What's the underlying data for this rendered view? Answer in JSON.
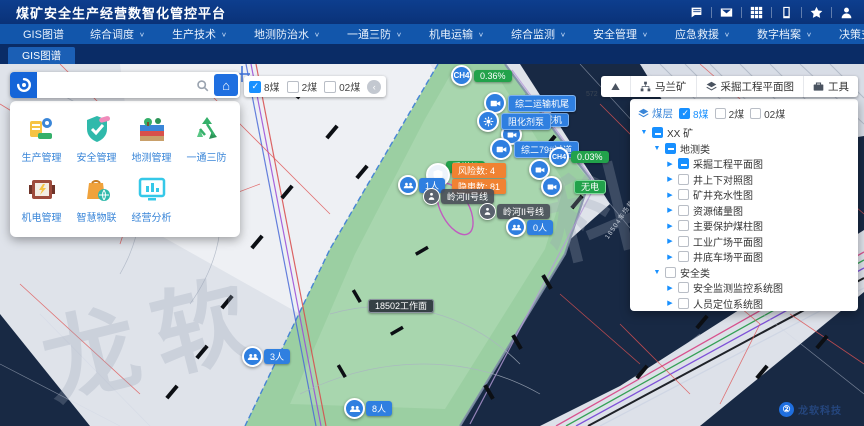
{
  "header": {
    "title": "煤矿安全生产经营数智化管控平台",
    "icons": [
      "chat-icon",
      "mail-icon",
      "apps-grid-icon",
      "mobile-icon",
      "star-icon",
      "user-icon"
    ]
  },
  "nav": {
    "items": [
      {
        "label": "GIS图谱",
        "dropdown": false
      },
      {
        "label": "综合调度",
        "dropdown": true
      },
      {
        "label": "生产技术",
        "dropdown": true
      },
      {
        "label": "地测防治水",
        "dropdown": true
      },
      {
        "label": "一通三防",
        "dropdown": true
      },
      {
        "label": "机电运输",
        "dropdown": true
      },
      {
        "label": "综合监测",
        "dropdown": true
      },
      {
        "label": "安全管理",
        "dropdown": true
      },
      {
        "label": "应急救援",
        "dropdown": true
      },
      {
        "label": "数字档案",
        "dropdown": true
      },
      {
        "label": "决策支持",
        "dropdown": true
      },
      {
        "label": "系统管理",
        "dropdown": true
      }
    ]
  },
  "tabs": {
    "active": "GIS图谱"
  },
  "apps": {
    "items": [
      {
        "label": "生产管理"
      },
      {
        "label": "安全管理"
      },
      {
        "label": "地测管理"
      },
      {
        "label": "一通三防"
      },
      {
        "label": "机电管理"
      },
      {
        "label": "智慧物联"
      },
      {
        "label": "经营分析"
      }
    ]
  },
  "coal_toolbar": {
    "options": [
      {
        "label": "8煤",
        "checked": true
      },
      {
        "label": "2煤",
        "checked": false
      },
      {
        "label": "02煤",
        "checked": false
      }
    ]
  },
  "right_toolbar": {
    "buttons": [
      {
        "label": "",
        "icon": "mine-icon"
      },
      {
        "label": "马兰矿",
        "icon": "org-tree-icon"
      },
      {
        "label": "采掘工程平面图",
        "icon": "layers-icon"
      },
      {
        "label": "工具",
        "icon": "toolbox-icon"
      }
    ]
  },
  "layer_panel": {
    "seam_label": "煤层",
    "seams": [
      {
        "label": "8煤",
        "checked": true
      },
      {
        "label": "2煤",
        "checked": false
      },
      {
        "label": "02煤",
        "checked": false
      }
    ],
    "tree": [
      {
        "label": "XX 矿"
      },
      {
        "label": "地测类"
      },
      {
        "label": "采掘工程平面图"
      },
      {
        "label": "井上下对照图"
      },
      {
        "label": "矿井充水性图"
      },
      {
        "label": "资源储量图"
      },
      {
        "label": "主要保护煤柱图"
      },
      {
        "label": "工业广场平面图"
      },
      {
        "label": "井底车场平面图"
      },
      {
        "label": "安全类"
      },
      {
        "label": "安全监测监控系统图"
      },
      {
        "label": "人员定位系统图"
      }
    ]
  },
  "map": {
    "markers": {
      "ch4_1": {
        "gas": "CH4",
        "value": "0.36%"
      },
      "ch4_2": {
        "gas": "CH4",
        "value": "0.03%"
      },
      "cam_transporter": {
        "label": "综二运输机尾"
      },
      "loader": {
        "label": "转载机"
      },
      "pump": {
        "label": "阻化剂泵"
      },
      "crossing": {
        "label": "综二79#过道"
      },
      "shearer": {
        "label": "采煤机"
      },
      "no_power": {
        "label": "无电"
      },
      "risk": {
        "label": "风险数: 4"
      },
      "hazard": {
        "label": "隐患数: 81"
      },
      "line1": {
        "label": "岭河II号线"
      },
      "line2": {
        "label": "岭河II号线"
      },
      "people_1": {
        "label": "1人"
      },
      "people_0": {
        "label": "0人"
      },
      "people_3": {
        "label": "3人"
      },
      "people_8": {
        "label": "8人"
      },
      "workface": {
        "label": "18502工作面"
      }
    },
    "texts": {
      "elevation": "572",
      "corridor": "18504车场巷"
    },
    "logo": {
      "label": "龙软科技"
    },
    "colors": {
      "background": "#182944",
      "paper": "#dfe3ea",
      "workface_green": "#9bcfa2",
      "marker_blue": "#2f7fe0",
      "ok_green": "#22a24b",
      "warn_orange": "#f08232",
      "check_blue": "#1890ff"
    }
  }
}
